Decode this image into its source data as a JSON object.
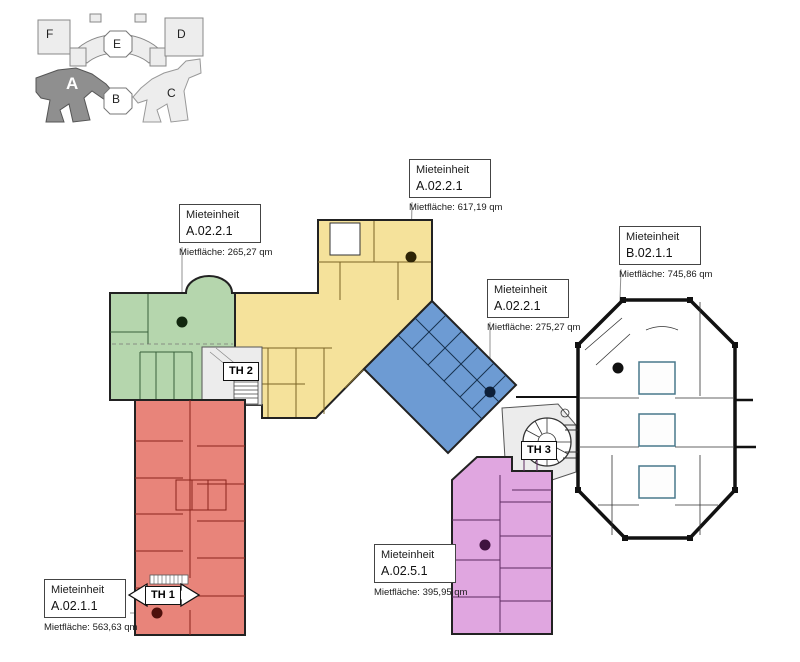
{
  "colors": {
    "green": "#b5d6ad",
    "yellow": "#f5e29b",
    "blue": "#6d9bd3",
    "purple": "#e0a6e0",
    "red": "#e8847a",
    "white_unit": "#ffffff",
    "keyplan_dark": "#8f8f8f",
    "keyplan_light": "#ededed",
    "stair_gray": "#ececec"
  },
  "key_plan": {
    "buildings": [
      {
        "label": "F"
      },
      {
        "label": "E"
      },
      {
        "label": "D"
      },
      {
        "label": "A"
      },
      {
        "label": "B"
      },
      {
        "label": "C"
      }
    ]
  },
  "units": [
    {
      "name": "green",
      "title": "Mieteinheit",
      "code": "A.02.2.1",
      "area": "Mietfläche: 265,27 qm"
    },
    {
      "name": "yellow",
      "title": "Mieteinheit",
      "code": "A.02.2.1",
      "area": "Mietfläche: 617,19 qm"
    },
    {
      "name": "blue",
      "title": "Mieteinheit",
      "code": "A.02.2.1",
      "area": "Mietfläche: 275,27 qm"
    },
    {
      "name": "b-building",
      "title": "Mieteinheit",
      "code": "B.02.1.1",
      "area": "Mietfläche: 745,86 qm"
    },
    {
      "name": "red",
      "title": "Mieteinheit",
      "code": "A.02.1.1",
      "area": "Mietfläche: 563,63 qm"
    },
    {
      "name": "purple",
      "title": "Mieteinheit",
      "code": "A.02.5.1",
      "area": "Mietfläche: 395,95 qm"
    }
  ],
  "stairs": [
    {
      "label": "TH 1"
    },
    {
      "label": "TH 2"
    },
    {
      "label": "TH 3"
    }
  ]
}
